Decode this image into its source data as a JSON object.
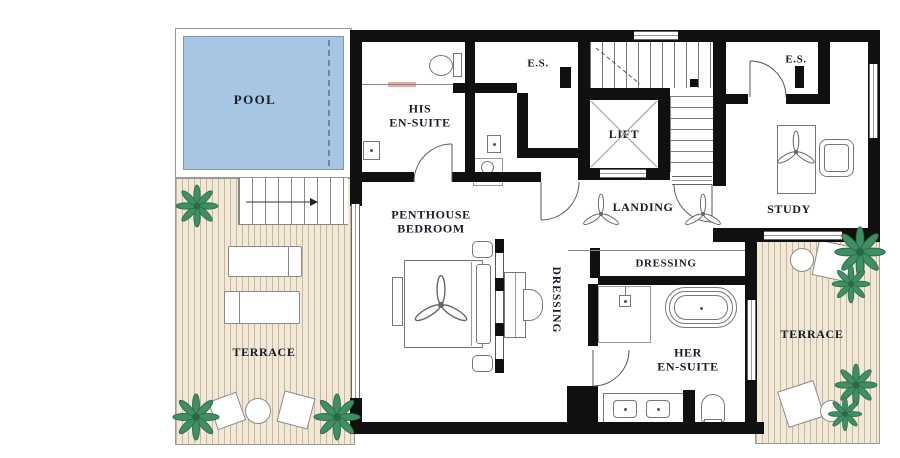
{
  "title": "Penthouse floor plan",
  "rooms": {
    "pool": {
      "label": "POOL"
    },
    "terrace_left": {
      "label": "TERRACE"
    },
    "terrace_right": {
      "label": "TERRACE"
    },
    "his_ensuite": {
      "line1": "HIS",
      "line2": "EN-SUITE"
    },
    "es_left": {
      "label": "E.S."
    },
    "es_right": {
      "label": "E.S."
    },
    "lift": {
      "label": "LIFT"
    },
    "landing": {
      "label": "LANDING"
    },
    "study": {
      "label": "STUDY"
    },
    "penthouse_bedroom": {
      "line1": "PENTHOUSE",
      "line2": "BEDROOM"
    },
    "dressing_corridor": {
      "label": "DRESSING"
    },
    "dressing_room": {
      "label": "DRESSING"
    },
    "her_ensuite": {
      "line1": "HER",
      "line2": "EN-SUITE"
    }
  },
  "colors": {
    "wall": "#101010",
    "pool_fill": "#a6c6e4",
    "pool_edge": "#7e97b5",
    "terrace_deck": "#f1e8d8",
    "terrace_stripe": "#c9b69c",
    "plant_green": "#3f8f63",
    "pocket_door_accent": "#e6aca4"
  },
  "icons": {
    "ceiling_fan": "three-blade fan glyph",
    "plant": "foliage starburst",
    "stair_arrow": "direction arrow"
  }
}
